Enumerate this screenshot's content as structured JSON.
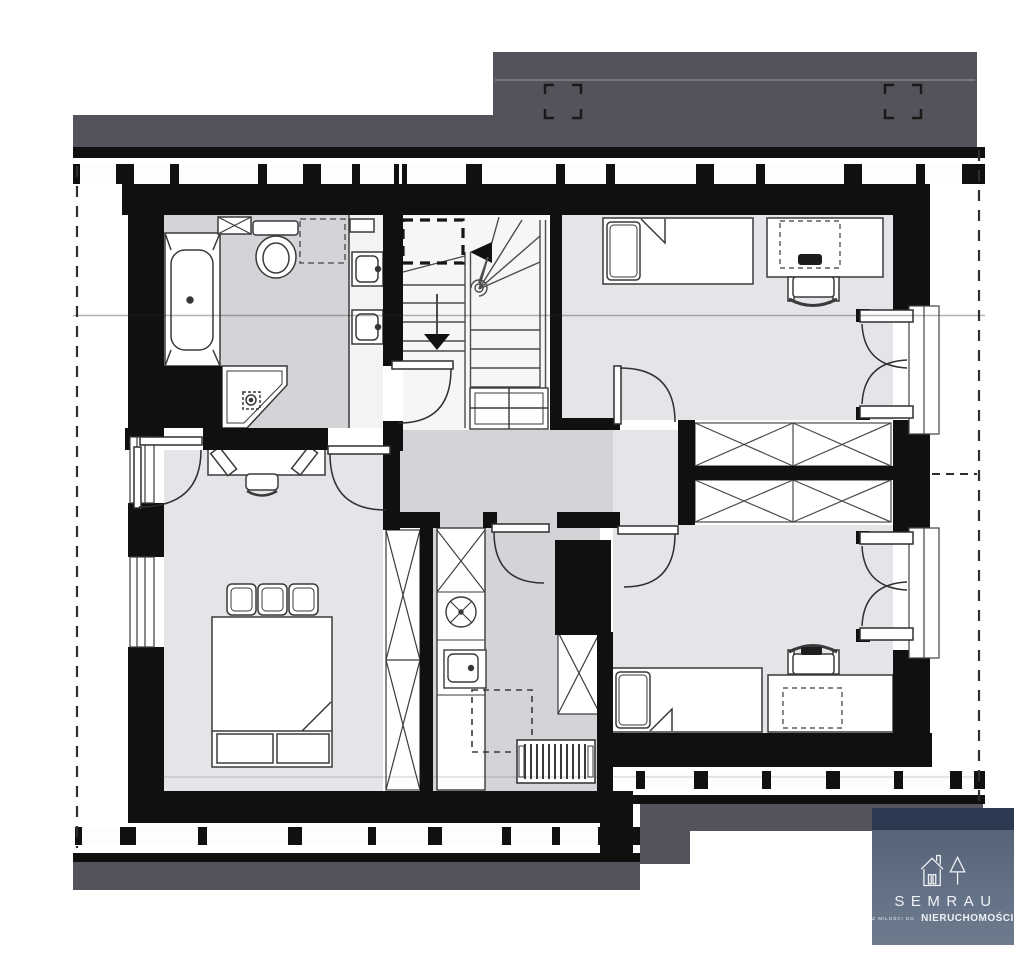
{
  "logo": {
    "brand": "SEMRAU",
    "tagline_small": "Z MIŁOŚCI DO",
    "tagline_large": "NIERUCHOMOŚCI",
    "colors": {
      "header_navy": "#2c3950",
      "panel_top": "#566478",
      "panel_bottom": "#6e7b8d",
      "text": "#f0f2f5"
    }
  },
  "plan": {
    "palette": {
      "paper": "#ffffff",
      "wall": "#101010",
      "roof_band": "#56525b",
      "wet_floor": "#d3d4d8",
      "room_floor": "#e4e5e8",
      "fixture_fill": "#ffffff",
      "line": "#3c3c3c"
    },
    "rooms": [
      {
        "id": "bathroom",
        "fixtures": [
          "bathtub",
          "corner-shower",
          "toilet",
          "washbasin",
          "washbasin",
          "storage-closet"
        ]
      },
      {
        "id": "staircase",
        "features": [
          "winder-stairs",
          "handrail",
          "direction-arrow-up",
          "direction-arrow-down",
          "roof-window-dashed"
        ]
      },
      {
        "id": "hallway",
        "features": [
          "under-stair-shelf"
        ]
      },
      {
        "id": "bedroom-top-right",
        "furniture": [
          "single-bed",
          "desk",
          "office-chair",
          "french-door"
        ]
      },
      {
        "id": "bedroom-bottom-right",
        "furniture": [
          "single-bed",
          "desk",
          "office-chair",
          "french-door"
        ]
      },
      {
        "id": "bedroom-bottom-left",
        "furniture": [
          "double-bed",
          "pillows",
          "desk",
          "chair",
          "wardrobe"
        ]
      },
      {
        "id": "utility-room",
        "fixtures": [
          "tall-cabinet",
          "round-appliance",
          "sink",
          "under-counter-appliance",
          "radiator",
          "wardrobe"
        ]
      },
      {
        "id": "wardrobe-block",
        "fixtures": [
          "wardrobe",
          "wardrobe",
          "wardrobe",
          "wardrobe"
        ]
      }
    ]
  }
}
